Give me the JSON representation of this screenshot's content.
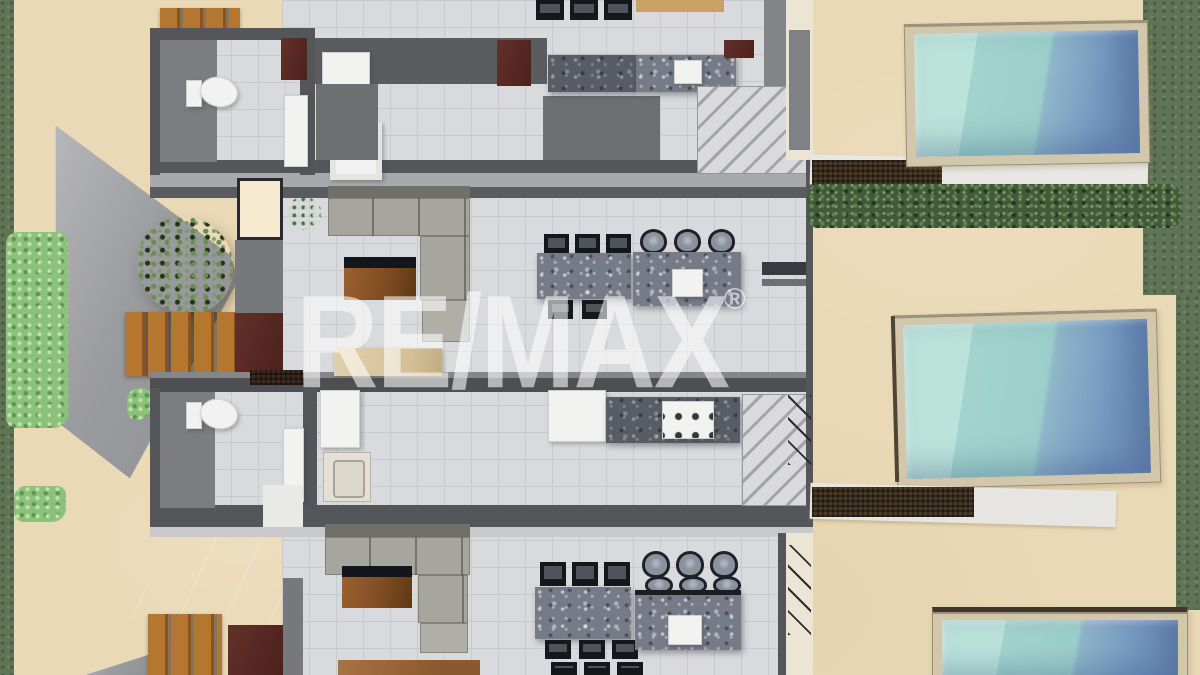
{
  "watermark": {
    "text": "RE/MAX",
    "registered": "®",
    "color": "#ffffff",
    "opacity": 0.58
  },
  "scene": {
    "kind": "3d-top-down-floor-plan-render",
    "units_visible": 3,
    "pools_visible": 3,
    "palette": {
      "sand": "#ead9b6",
      "floor": "#d9dadd",
      "wall": "#55565a",
      "pool_rim": "#d2c6ab",
      "pool_water_light": "#bce3da",
      "pool_water_deep": "#6d8cb6",
      "hedge": "#42593b",
      "grass": "#5f7355",
      "bush": "#8cc17b",
      "wood_deck": "#b5762f",
      "wood_furniture": "#8a5426",
      "door": "#57281f",
      "sofa": "#a7a69e",
      "granite": "#767b88",
      "appliance": "#f2f2f1",
      "chair": "#15171b"
    }
  }
}
